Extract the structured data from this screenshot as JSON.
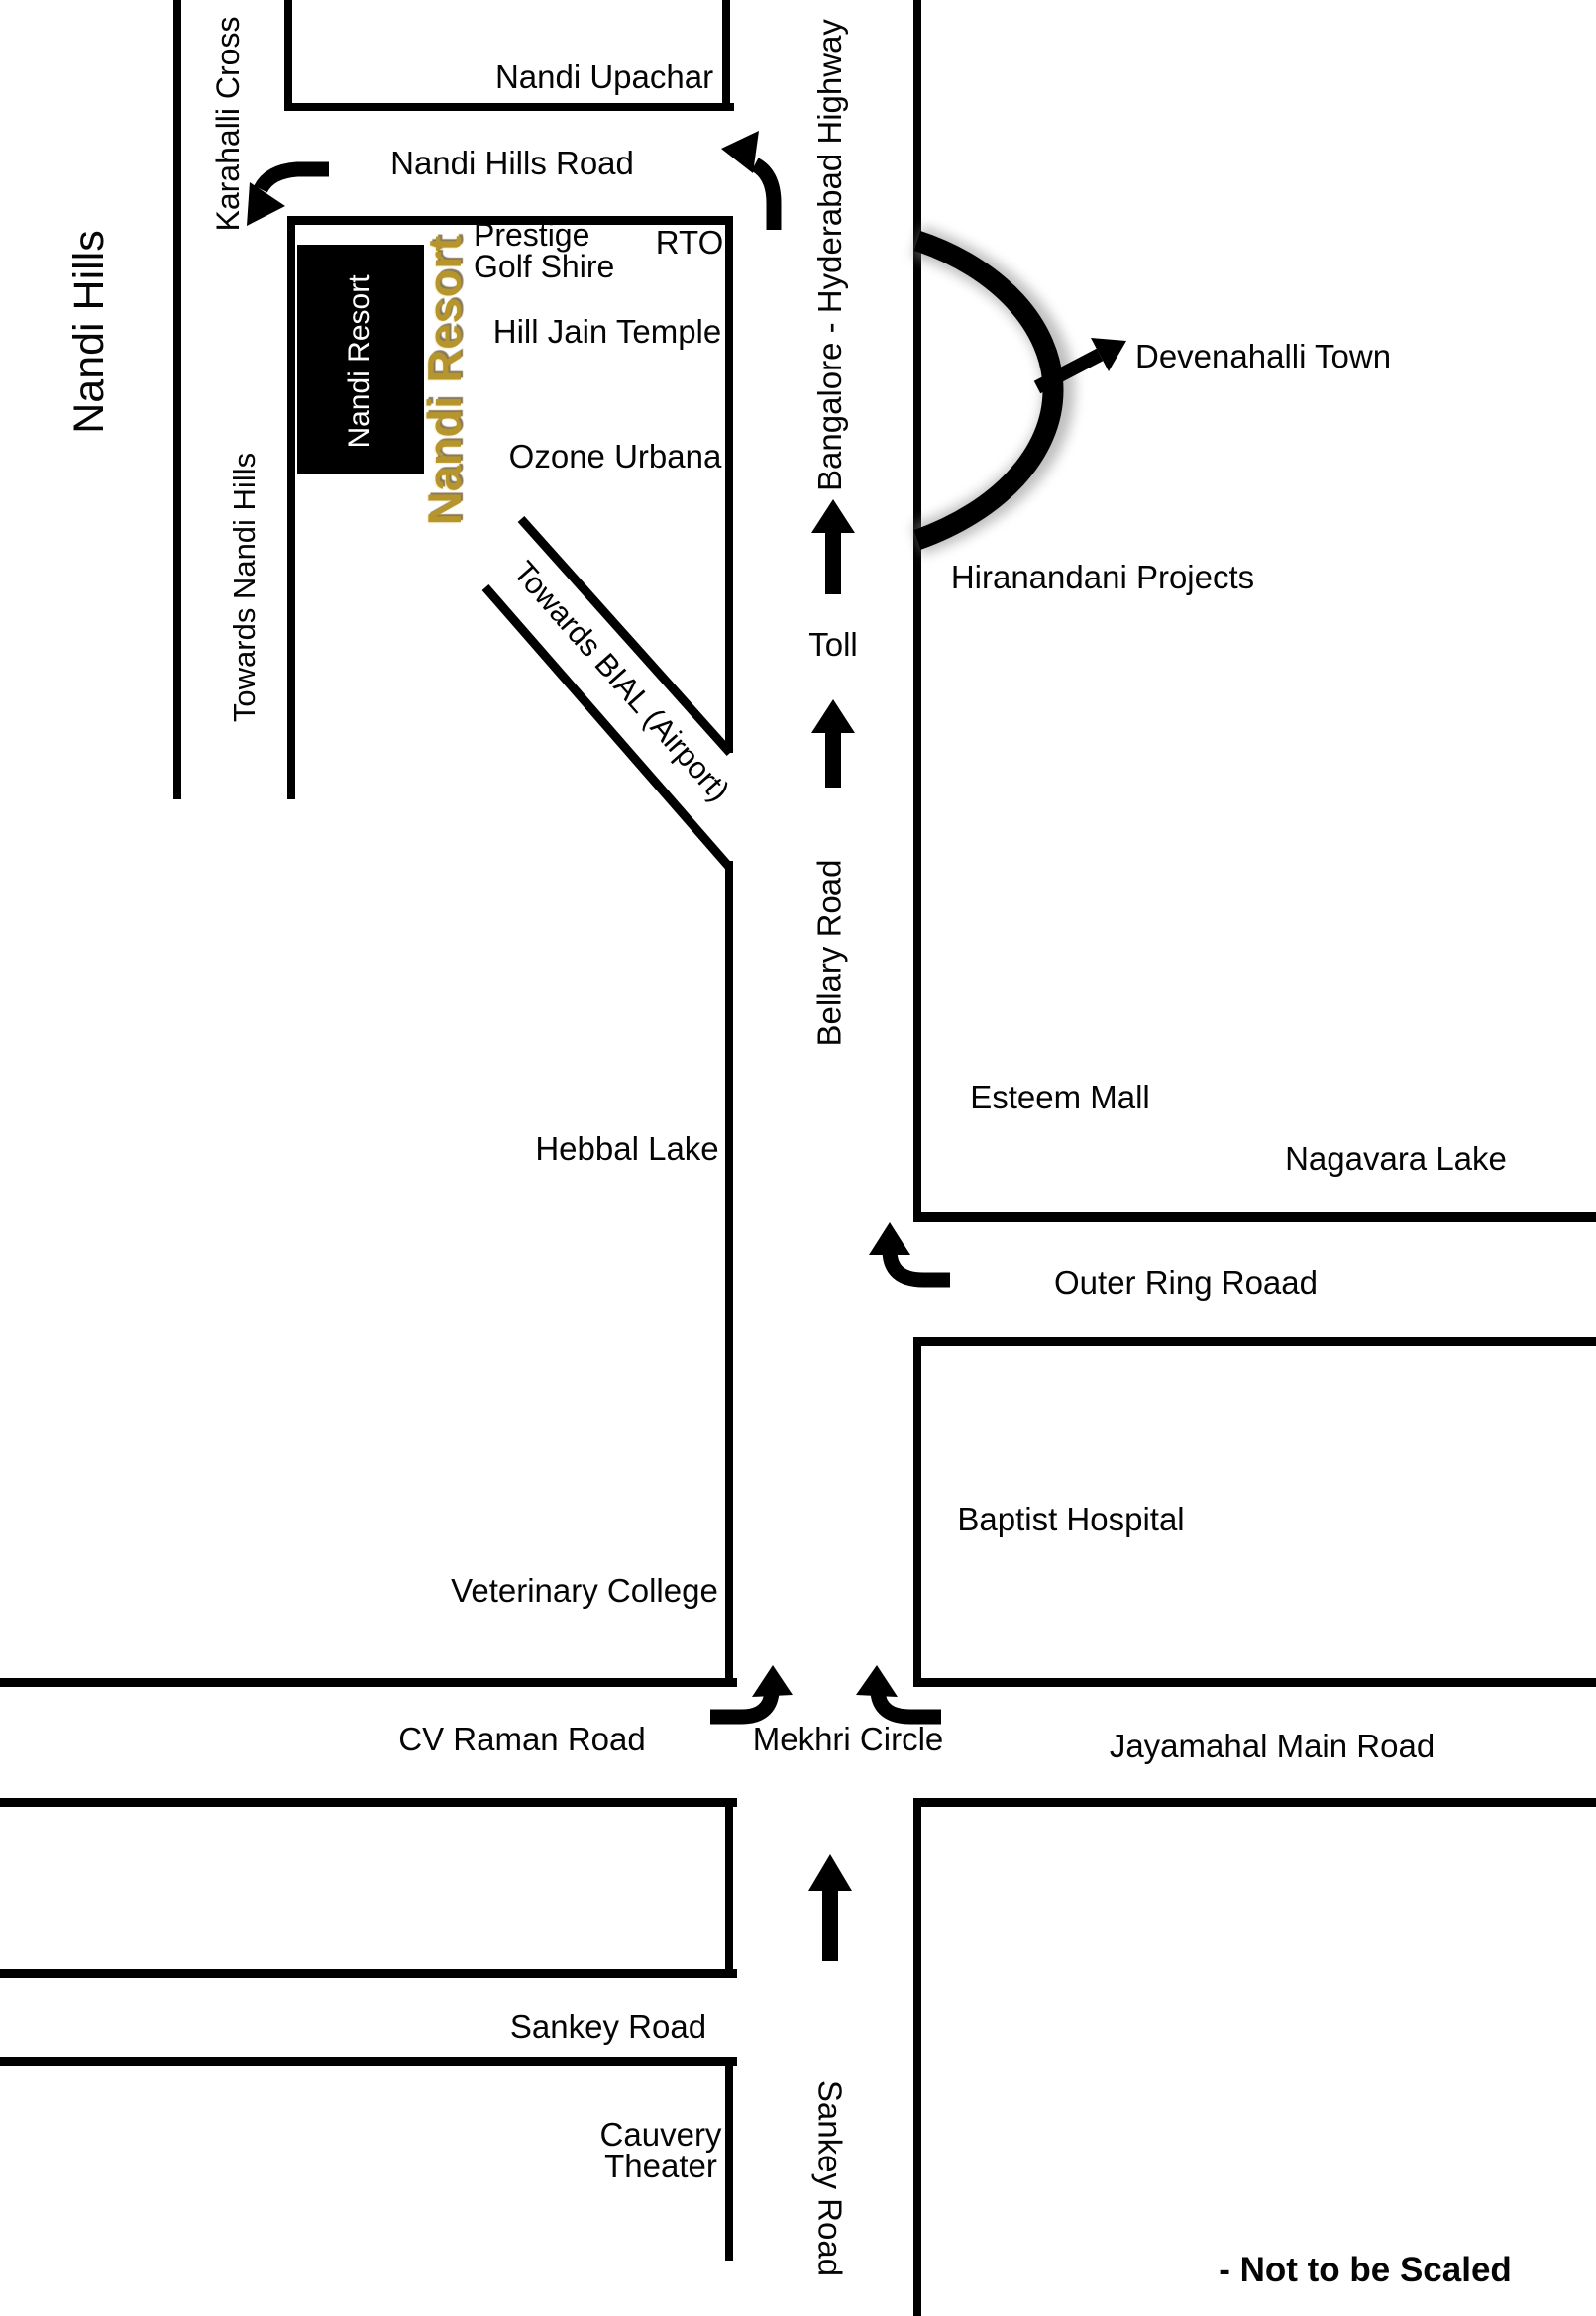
{
  "canvas": {
    "background": "#ffffff",
    "road_color": "#000000",
    "gold_accent": "#b6952d",
    "text_color": "#050505"
  },
  "labels": {
    "nandi_hills": "Nandi Hills",
    "karahalli_cross": "Karahalli Cross",
    "towards_nandi_hills": "Towards Nandi Hills",
    "nandi_upachar": "Nandi Upachar",
    "nandi_hills_road": "Nandi Hills Road",
    "prestige": "Prestige",
    "golf_shire": "Golf Shire",
    "rto": "RTO",
    "hill_jain_temple": "Hill Jain Temple",
    "ozone_urbana": "Ozone Urbana",
    "nandi_resort_box": "Nandi Resort",
    "nandi_resort_gold": "Nandi Resort",
    "towards_bial": "Towards BIAL (Airport)",
    "bangalore_hyderabad_highway": "Bangalore - Hyderabad Highway",
    "devenahalli_town": "Devenahalli Town",
    "hiranandani_projects": "Hiranandani Projects",
    "toll": "Toll",
    "bellary_road": "Bellary Road",
    "esteem_mall": "Esteem Mall",
    "hebbal_lake": "Hebbal Lake",
    "nagavara_lake": "Nagavara Lake",
    "outer_ring_road": "Outer Ring Roaad",
    "baptist_hospital": "Baptist Hospital",
    "veterinary_college": "Veterinary College",
    "cv_raman_road": "CV Raman Road",
    "mekhri_circle": "Mekhri Circle",
    "jayamahal_main_road": "Jayamahal Main Road",
    "sankey_road_horizontal": "Sankey Road",
    "cauvery_line1": "Cauvery",
    "cauvery_line2": "Theater",
    "sankey_road_vertical": "Sankey Road",
    "not_to_scale": "- Not to be Scaled"
  }
}
